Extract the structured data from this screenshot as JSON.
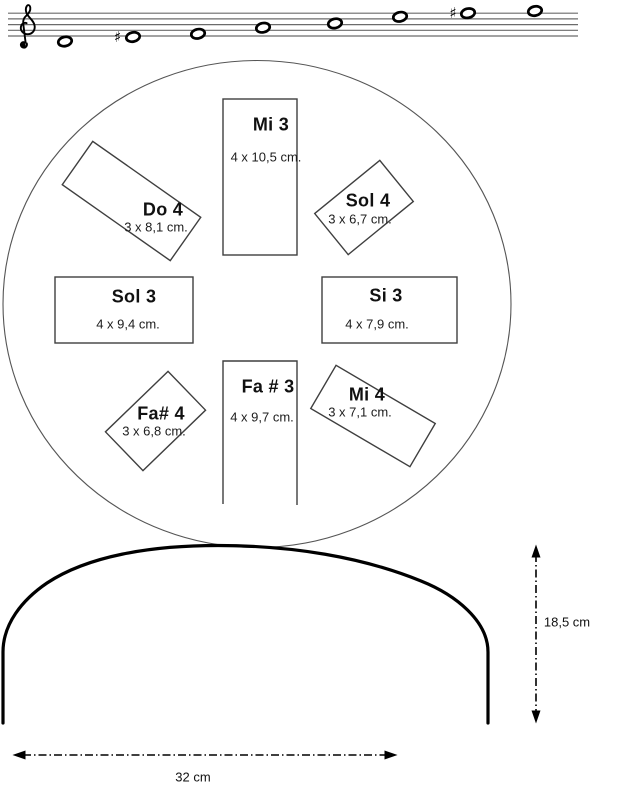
{
  "staff": {
    "clef": "treble",
    "sharp_symbol": "♯",
    "note_count": 8,
    "sharps_at_note_positions": [
      2,
      7
    ]
  },
  "drum_top_view": {
    "tongues": [
      {
        "note": "Mi 3",
        "size": "4 x 10,5 cm."
      },
      {
        "note": "Do 4",
        "size": "3 x 8,1 cm."
      },
      {
        "note": "Sol 4",
        "size": "3 x 6,7 cm."
      },
      {
        "note": "Sol 3",
        "size": "4 x 9,4 cm."
      },
      {
        "note": "Si 3",
        "size": "4 x 7,9 cm."
      },
      {
        "note": "Fa# 4",
        "size": "3 x 6,8 cm."
      },
      {
        "note": "Fa # 3",
        "size": "4 x 9,7 cm."
      },
      {
        "note": "Mi 4",
        "size": "3 x 7,1 cm."
      }
    ]
  },
  "drum_side_view": {
    "height_label": "18,5 cm",
    "width_label": "32 cm"
  },
  "colors": {
    "line_art": "#3f3f3f",
    "thick_outline": "#000000",
    "staff_line": "#6b6b6b"
  }
}
